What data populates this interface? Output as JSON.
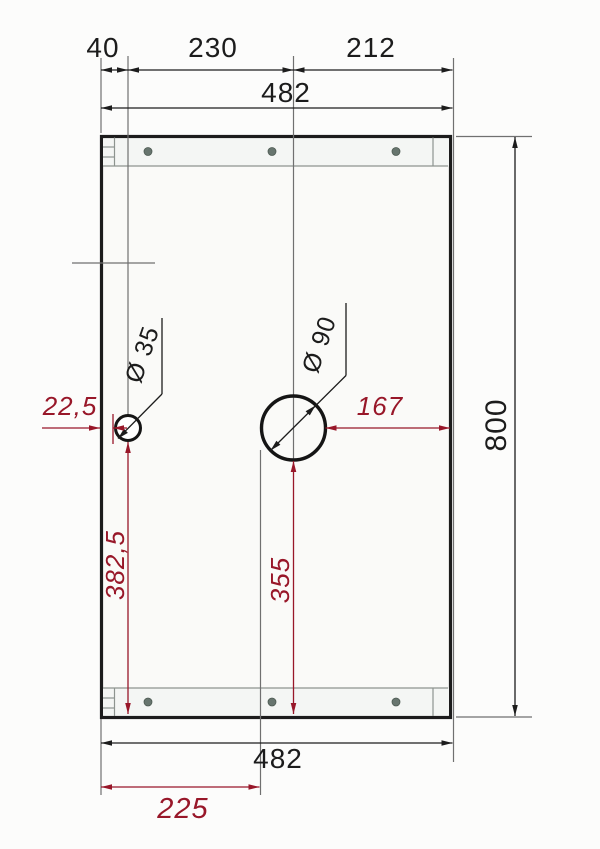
{
  "colors": {
    "bg": "#fcfcfb",
    "line": "#1c1c1c",
    "thin": "#707070",
    "accent": "#981729",
    "screw": "#67756e"
  },
  "dimensions": {
    "top": {
      "segment_left": "40",
      "segment_mid": "230",
      "segment_right": "212",
      "overall_width": "482"
    },
    "side": {
      "overall_height": "800"
    },
    "bottom": {
      "overall_width": "482",
      "hole_offset": "225"
    },
    "holes": {
      "small": {
        "label": "Ø 35",
        "edge_offset": "22,5",
        "bottom_offset": "382,5"
      },
      "large": {
        "label": "Ø 90",
        "right_offset": "167",
        "bottom_offset": "355"
      }
    }
  }
}
